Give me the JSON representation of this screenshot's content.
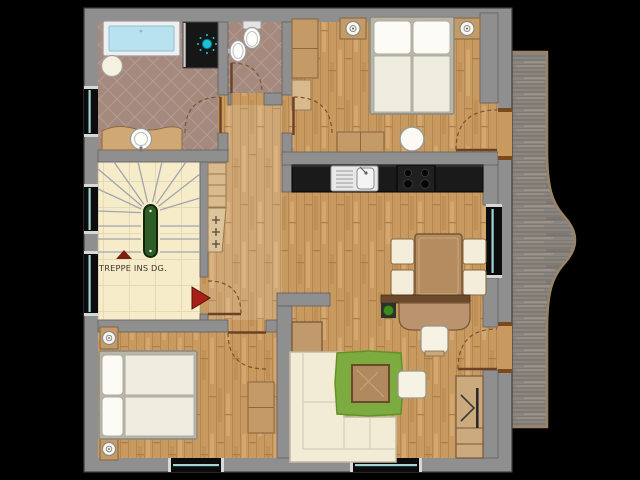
{
  "floorplan": {
    "stairs_label": "TREPPE INS DG.",
    "palette": {
      "background": "#000000",
      "wall": "#8f8f8f",
      "wood_floor": "#c89a60",
      "tile_floor": "#a5897d",
      "stairs_floor": "#f6ecca",
      "deck": "#8b8581",
      "deck_border": "#9a8468",
      "water_blue": "#b8e2ef",
      "glass_blue": "#9fd4d8",
      "rug_green": "#7cab40",
      "plant_green": "#3f8a1f",
      "handrail_green": "#2f5d28",
      "counter_black": "#1a1a1a",
      "furniture_wood": "#c49a66",
      "furniture_wood_dark": "#8a6a44",
      "door_brown": "#6b4226",
      "arrow_red": "#a82017",
      "shower_cyan": "#18c2d8"
    },
    "rooms": [
      {
        "id": "bathroom",
        "items": [
          "bathtub",
          "shower",
          "shower-head",
          "vanity-washbasin",
          "stool",
          "window"
        ]
      },
      {
        "id": "wc",
        "items": [
          "toilet",
          "washbasin"
        ]
      },
      {
        "id": "bedroom-north",
        "items": [
          "double-bed",
          "nightstand-left",
          "nightstand-right",
          "wardrobe",
          "dresser",
          "round-table",
          "balcony-door"
        ]
      },
      {
        "id": "staircase",
        "items": [
          "winder-stairs",
          "handrail",
          "direction-arrow",
          "entry-arrow",
          "stairs-label",
          "windows"
        ]
      },
      {
        "id": "hallway",
        "items": [
          "shelf",
          "coat-hooks"
        ]
      },
      {
        "id": "kitchen-dining",
        "items": [
          "counter",
          "sink",
          "cooktop",
          "dining-table",
          "dining-chairs",
          "window"
        ]
      },
      {
        "id": "bedroom-south",
        "items": [
          "double-bed",
          "nightstand-top",
          "nightstand-bottom",
          "dresser",
          "window"
        ]
      },
      {
        "id": "living-room",
        "items": [
          "corner-sofa",
          "rug",
          "coffee-table",
          "footstool",
          "side-table",
          "desk",
          "desk-chair",
          "sideboard",
          "plant",
          "tv-cabinet",
          "balcony-door",
          "window"
        ]
      },
      {
        "id": "balcony",
        "items": [
          "deck"
        ]
      }
    ]
  }
}
